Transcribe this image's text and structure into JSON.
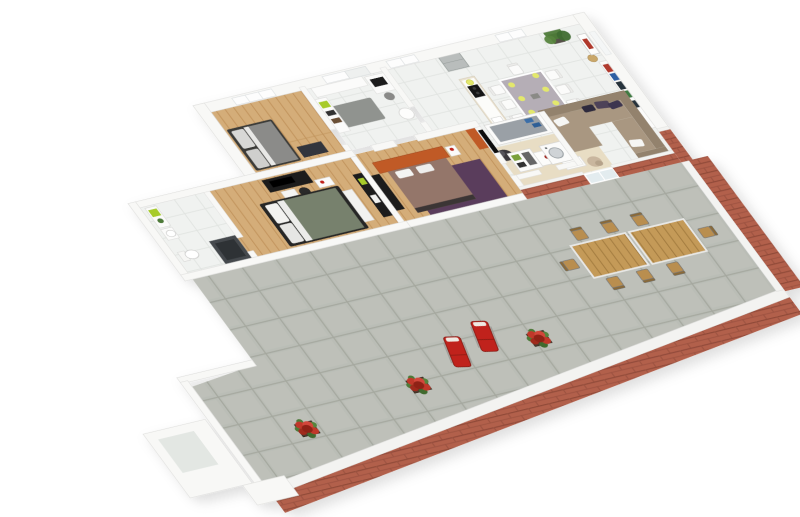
{
  "scene": {
    "kind": "3d-isometric-floor-plan-render",
    "description": "3D cutaway render of a 3-bedroom apartment floor plan with open kitchen-living area and a brick-edged stone terrace",
    "background": "#ffffff"
  },
  "palette": {
    "wall": "#f8f8f6",
    "wall_line": "#e0e0de",
    "wood": "#d4ad79",
    "wood_line": "#c2945d",
    "tile": "#f0f2f0",
    "tile_line": "#e1e4e1",
    "stone": "#babdb6",
    "stone_line": "#a5a89f",
    "stone_light": "#c3c6bf",
    "brick": "#b2604c",
    "brick_line": "#8f4a38",
    "brick_cap": "#f3f3f1",
    "sofa": "#a99781",
    "sofa_dark": "#93826d",
    "rug_cream": "#e8ddc4",
    "pillow_purple": "#4e4258",
    "white": "#fbfbfa",
    "bed_gray": "#8b8b89",
    "bed_green": "#77816d",
    "bed_mauve": "#94766a",
    "rug_purple": "#5a3d5c",
    "orange": "#c05a28",
    "black": "#1d1d1d",
    "steel": "#b9bdbc",
    "dining_table_top": "#b5aeb6",
    "plate_yellow": "#e3e86c",
    "red": "#c0241a",
    "slat": "#c49a58",
    "slat_line": "#a37c3f",
    "chair_wood": "#b98e4f",
    "flower": "#c0392b",
    "flower_dark": "#8f2418",
    "leaf": "#4e7a38",
    "planter": "#4b3a2f",
    "glass": "#e3ecef",
    "mat_gray": "#90938f",
    "shower": "#45494d",
    "shower_mat": "#2e3134",
    "lime": "#a7cb2b",
    "towel_blue": "#3a6ea8",
    "tub": "#9aa0a6",
    "lamp": "#c9a76a",
    "book_red": "#b03a2e",
    "book_blue": "#2e5fa3",
    "book_dark": "#27313b",
    "island_body": "#e9e1d0"
  },
  "rooms": [
    {
      "id": "bedroom-top",
      "label": "bedroom with grey bed",
      "floor": "wood"
    },
    {
      "id": "entry-hall",
      "label": "entry hall with desk and printer",
      "floor": "tile"
    },
    {
      "id": "kitchen-dining",
      "label": "open kitchen and dining area",
      "floor": "tile"
    },
    {
      "id": "living-room",
      "label": "living room with sectional sofa",
      "floor": "tile"
    },
    {
      "id": "master-bedroom",
      "label": "master bedroom with green bed and media desk",
      "floor": "wood"
    },
    {
      "id": "bathroom-main",
      "label": "bathroom with shower and toilet",
      "floor": "tile"
    },
    {
      "id": "bedroom-middle",
      "label": "bedroom with orange headboard and purple rug",
      "floor": "wood"
    },
    {
      "id": "bathroom-laundry",
      "label": "bathroom with tub and washer",
      "floor": "tile"
    },
    {
      "id": "terrace",
      "label": "stone terrace with brick parapet",
      "floor": "stone"
    }
  ],
  "furniture": {
    "kitchen": [
      "fridge",
      "island with cooktop and sink",
      "water-heater-cylinder",
      "yellow bowl"
    ],
    "dining": [
      "lavender dining table",
      "8 white chairs",
      "6 yellow plates",
      "potted plant"
    ],
    "living": [
      "beige L-sectional sofa",
      "purple and white pillows",
      "cream rug",
      "2 white coffee tables",
      "red vase",
      "dark armchair",
      "beige armchair",
      "bookshelf",
      "lamp",
      "framed picture"
    ],
    "master_bedroom": [
      "double bed green duvet",
      "black media desk with TV",
      "office chair",
      "white bench",
      "black wardrobe",
      "nightstand with red bottle"
    ],
    "bedroom_top": [
      "grey double bed",
      "window"
    ],
    "bedroom_middle": [
      "mauve double bed",
      "orange headboard unit",
      "purple rug",
      "orange cabinet",
      "black wardrobe",
      "wall TV"
    ],
    "bathroom_main": [
      "shelf unit with lime box",
      "sink",
      "toilet",
      "dark shower"
    ],
    "bathroom_laundry": [
      "bathtub with blue towels",
      "washing machine",
      "shelf unit"
    ],
    "terrace": [
      "2 wooden slat tables",
      "8 outdoor chairs",
      "2 red sun loungers",
      "3 red flower planters",
      "glass door"
    ]
  },
  "counts": {
    "indoor_dining_chairs": 8,
    "indoor_plates": 6,
    "outdoor_dining_chairs": 8,
    "sun_loungers": 2,
    "flower_planters": 3
  }
}
